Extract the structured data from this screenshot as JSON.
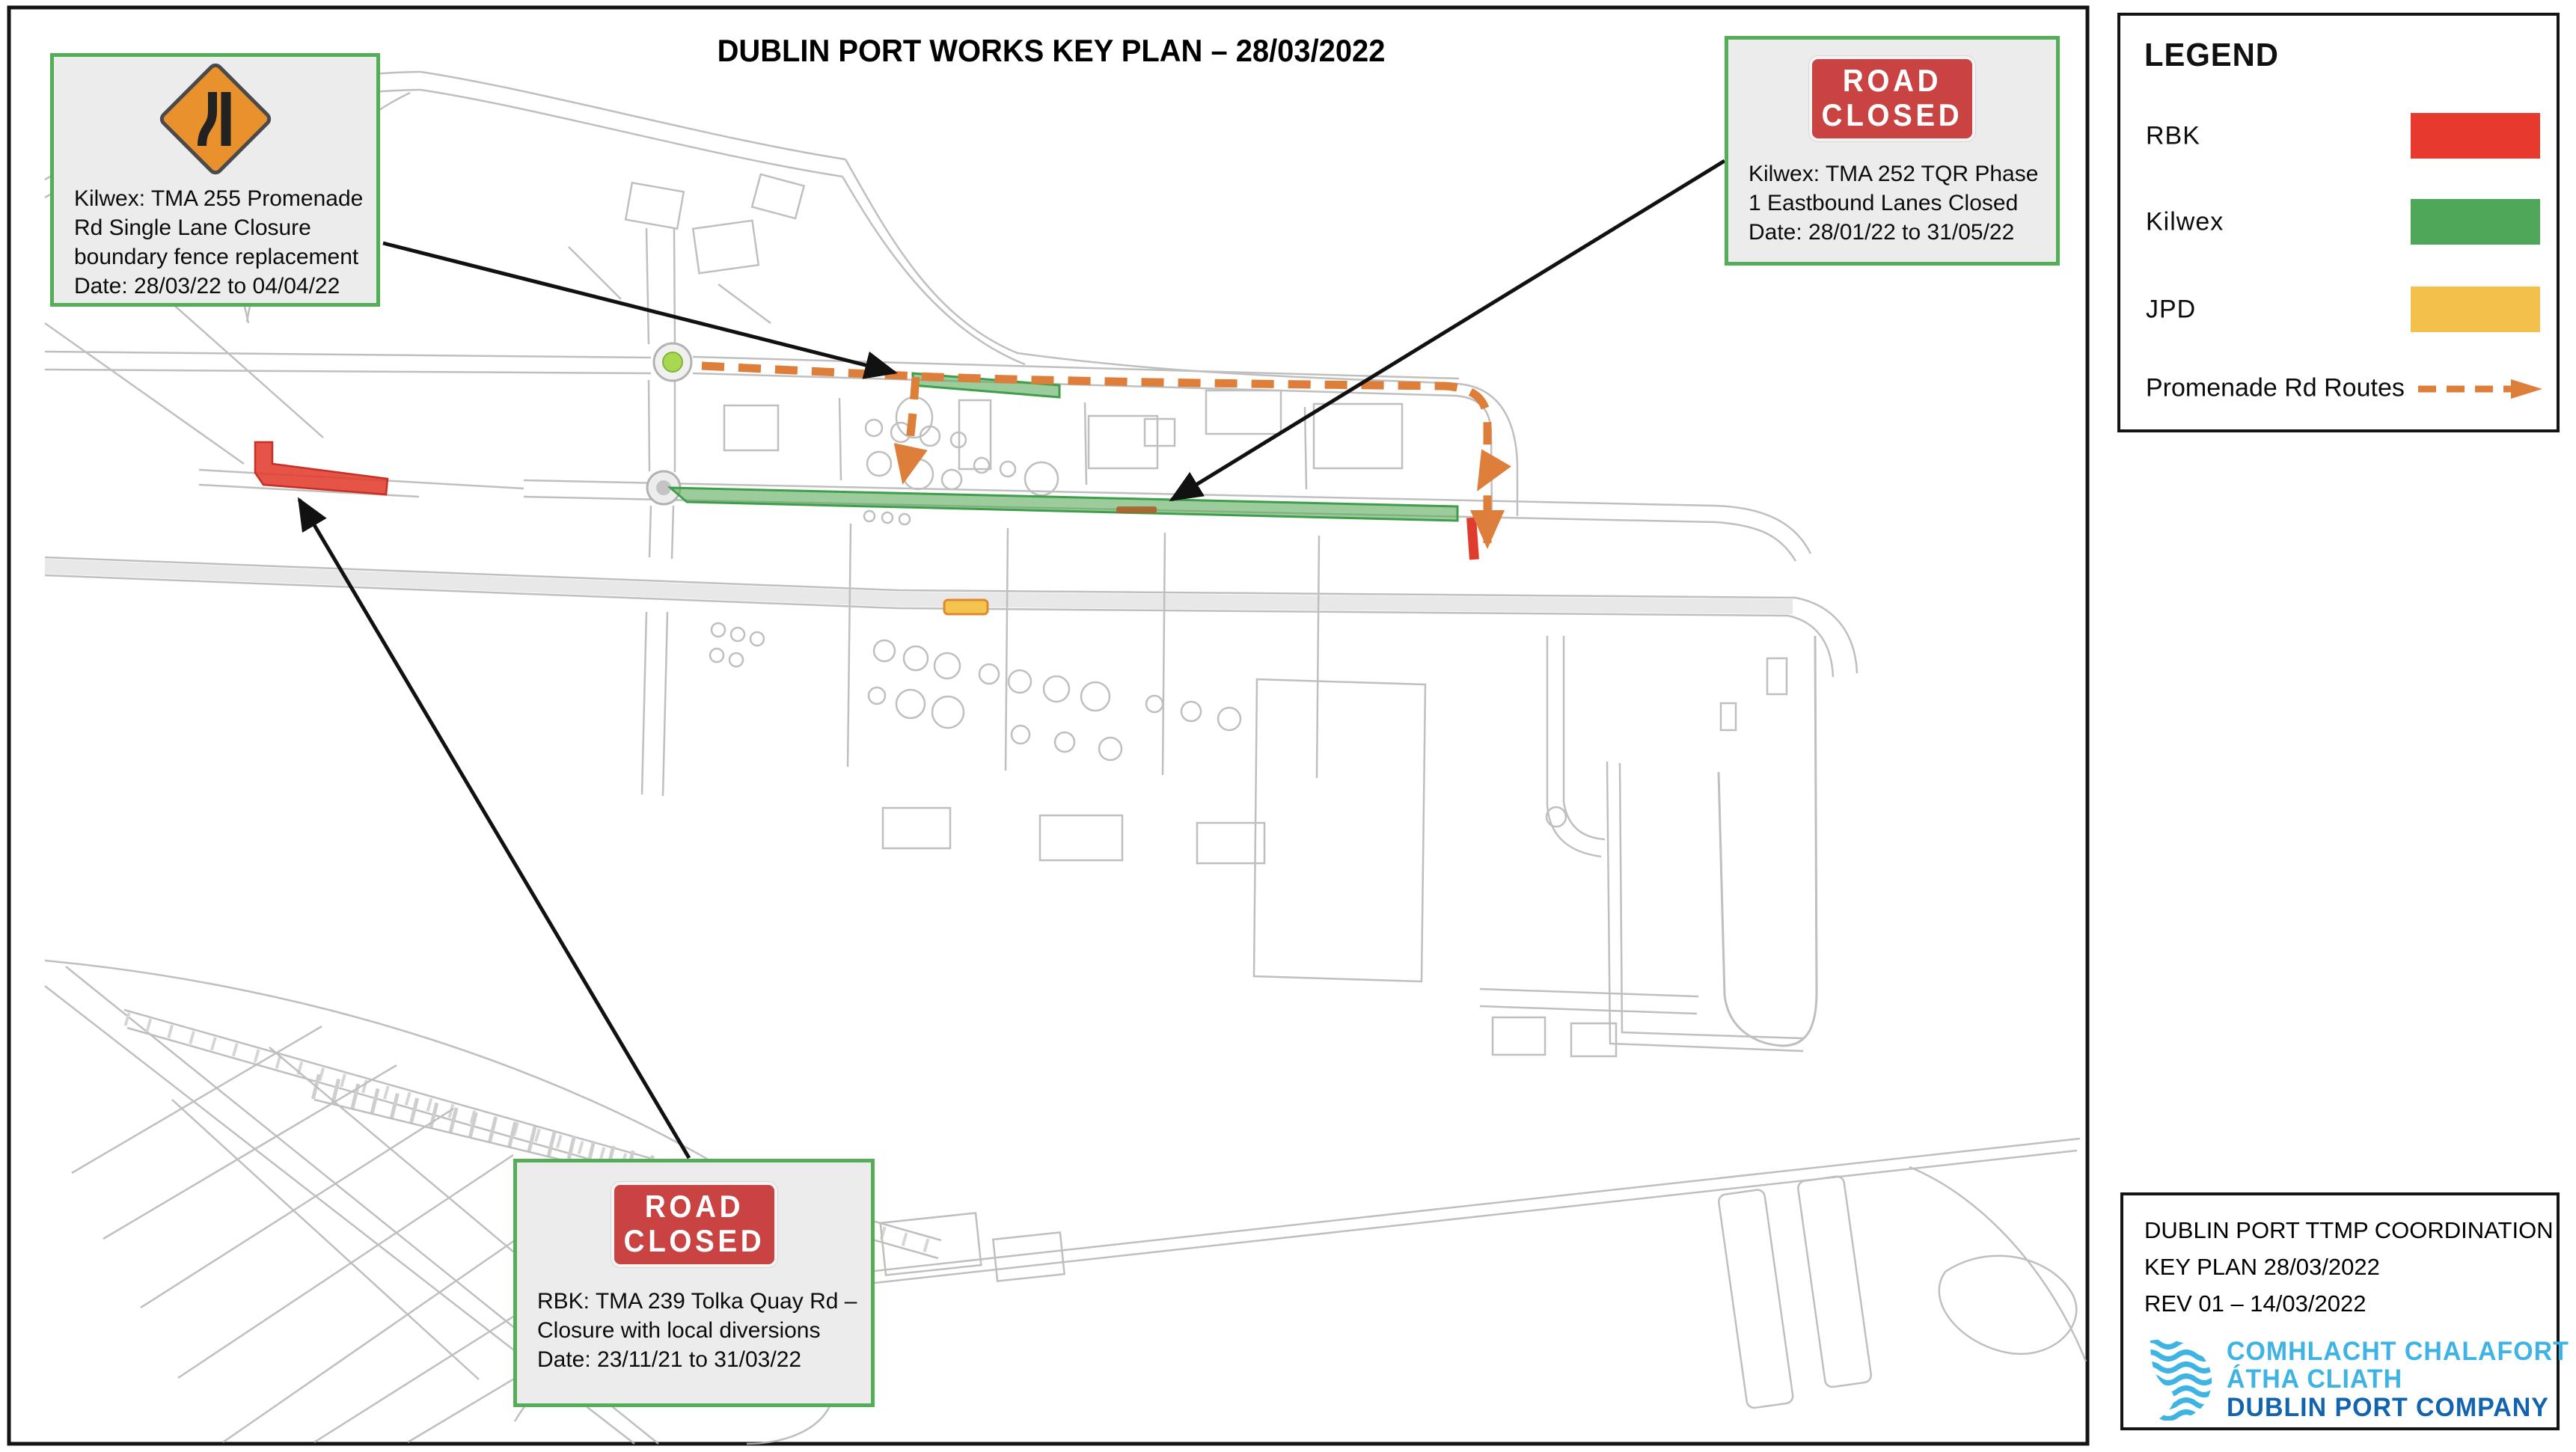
{
  "title": "DUBLIN PORT WORKS KEY PLAN – 28/03/2022",
  "legend": {
    "heading": "LEGEND",
    "items": [
      {
        "label": "RBK",
        "color": "#e8392f"
      },
      {
        "label": "Kilwex",
        "color": "#4fa85a"
      },
      {
        "label": "JPD",
        "color": "#f3c14b"
      }
    ],
    "route": {
      "label": "Promenade Rd Routes",
      "color": "#dd7e3b",
      "style": "dashed-arrow"
    }
  },
  "callouts": {
    "promenade_lane_closure": {
      "sign": "road-narrows-sign",
      "lines": [
        "Kilwex: TMA 255 Promenade",
        "Rd Single Lane Closure",
        "boundary fence replacement",
        "Date: 28/03/22 to 04/04/22"
      ]
    },
    "tqr_eastbound_closure": {
      "sign_lines": [
        "ROAD",
        "CLOSED"
      ],
      "lines": [
        "Kilwex: TMA 252 TQR Phase",
        "1 Eastbound Lanes Closed",
        "Date: 28/01/22 to 31/05/22"
      ]
    },
    "tolka_quay_closure": {
      "sign_lines": [
        "ROAD",
        "CLOSED"
      ],
      "lines": [
        "RBK: TMA 239 Tolka Quay Rd –",
        "Closure with local diversions",
        "Date: 23/11/21 to 31/03/22"
      ]
    }
  },
  "title_block": {
    "lines": [
      "DUBLIN PORT TTMP COORDINATION",
      "KEY PLAN  28/03/2022",
      "REV 01 – 14/03/2022"
    ]
  },
  "logo": {
    "line1": "COMHLACHT CHALAFORT",
    "line2": "ÁTHA CLIATH",
    "line3": "DUBLIN PORT COMPANY",
    "light_color": "#3fb3e4",
    "dark_color": "#1164ad"
  },
  "map_overlays": {
    "rbk_color": "#e8392f",
    "kilwex_color": "#4fa85a",
    "jpd_color": "#f3c14b",
    "promenade_route_color": "#dd7e3b"
  }
}
